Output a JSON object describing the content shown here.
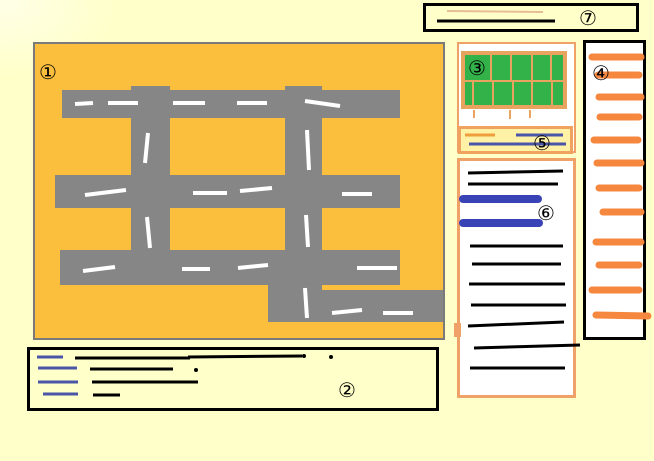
{
  "regions": {
    "map": {
      "label": "①"
    },
    "legend": {
      "label": "②"
    },
    "grid_table": {
      "label": "③"
    },
    "sidebar": {
      "label": "④"
    },
    "toolbar": {
      "label": "⑤"
    },
    "list": {
      "label": "⑥"
    },
    "titlebar": {
      "label": "⑦"
    }
  },
  "colors": {
    "page_bg": "#FFFFC9",
    "map_bg": "#FBBE3D",
    "map_border": "#7A7A7A",
    "road": "#868686",
    "dash": "#FFFFFF",
    "panel_border": "#F0A167",
    "panel_border2": "#F0A25F",
    "green": "#33B24A",
    "grid": "#E8A35F",
    "toolbar_bg": "#FFF1A6",
    "blue": "#4A55A8",
    "royal": "#3A43B5",
    "orange": "#F6873E",
    "orange2": "#EF9E3D",
    "tan": "#E7BD96",
    "black": "#000000"
  },
  "sketch": {
    "map": {
      "roads": [
        [
          27,
          46,
          338,
          28
        ],
        [
          20,
          131,
          345,
          33
        ],
        [
          25,
          206,
          340,
          35
        ],
        [
          96,
          42,
          39,
          199
        ],
        [
          250,
          42,
          37,
          172
        ],
        [
          233,
          206,
          54,
          72
        ],
        [
          265,
          246,
          143,
          32
        ]
      ],
      "dashes": [
        [
          40,
          60,
          58,
          59
        ],
        [
          73,
          59,
          103,
          59
        ],
        [
          138,
          59,
          170,
          59
        ],
        [
          202,
          59,
          232,
          59
        ],
        [
          270,
          57,
          305,
          62
        ],
        [
          50,
          151,
          91,
          146
        ],
        [
          158,
          149,
          192,
          149
        ],
        [
          205,
          147,
          237,
          144
        ],
        [
          307,
          150,
          337,
          150
        ],
        [
          48,
          227,
          80,
          223
        ],
        [
          147,
          225,
          175,
          225
        ],
        [
          203,
          224,
          233,
          221
        ],
        [
          322,
          224,
          362,
          224
        ],
        [
          297,
          269,
          327,
          266
        ],
        [
          348,
          269,
          378,
          269
        ],
        [
          113,
          89,
          110,
          119
        ],
        [
          112,
          173,
          115,
          204
        ],
        [
          272,
          86,
          274,
          126
        ],
        [
          271,
          171,
          273,
          203
        ],
        [
          270,
          244,
          272,
          274
        ]
      ]
    },
    "legend": {
      "blue": [
        [
          7,
          7,
          33,
          7
        ],
        [
          8,
          18,
          47,
          18
        ],
        [
          8,
          32,
          48,
          32
        ],
        [
          13,
          44,
          48,
          44
        ]
      ],
      "black": [
        [
          45,
          8,
          160,
          8
        ],
        [
          158,
          7,
          272,
          6
        ],
        [
          60,
          19,
          143,
          19
        ],
        [
          62,
          32,
          168,
          32
        ],
        [
          63,
          45,
          90,
          45
        ]
      ],
      "dots": [
        [
          274,
          6
        ],
        [
          301,
          7
        ],
        [
          166,
          20
        ]
      ]
    },
    "titlebar": {
      "tan_line": [
        21,
        5,
        117,
        6
      ],
      "black_line": [
        11,
        15,
        129,
        15
      ]
    },
    "grid_table": {
      "rect": [
        4,
        9,
        102,
        54
      ],
      "grid": [
        [
          5,
          37,
          107,
          37
        ],
        [
          32,
          11,
          32,
          37
        ],
        [
          52,
          11,
          52,
          37
        ],
        [
          73,
          11,
          73,
          37
        ],
        [
          92,
          11,
          92,
          37
        ],
        [
          14,
          37,
          14,
          63
        ],
        [
          34,
          37,
          34,
          63
        ],
        [
          54,
          37,
          54,
          63
        ],
        [
          73,
          37,
          73,
          63
        ],
        [
          93,
          37,
          93,
          63
        ]
      ],
      "ticks": [
        [
          15,
          66,
          15,
          74
        ],
        [
          51,
          66,
          51,
          75
        ],
        [
          71,
          66,
          71,
          74
        ]
      ]
    },
    "toolbar": {
      "orange_line": [
        4,
        6,
        34,
        6
      ],
      "blue": [
        [
          55,
          6,
          102,
          6
        ],
        [
          8,
          15,
          105,
          15
        ]
      ]
    },
    "list": {
      "black": [
        [
          8,
          12,
          103,
          10
        ],
        [
          8,
          23,
          98,
          23
        ],
        [
          10,
          85,
          103,
          85
        ],
        [
          12,
          103,
          101,
          103
        ],
        [
          9,
          123,
          105,
          123
        ],
        [
          11,
          144,
          106,
          144
        ],
        [
          8,
          165,
          104,
          161
        ],
        [
          14,
          187,
          120,
          184
        ],
        [
          10,
          207,
          105,
          207
        ]
      ],
      "blue_bars": [
        [
          3,
          38,
          78,
          38
        ],
        [
          3,
          62,
          79,
          62
        ]
      ]
    },
    "sidebar": {
      "strokes": [
        [
          6,
          14,
          55,
          14
        ],
        [
          12,
          32,
          53,
          32
        ],
        [
          13,
          54,
          55,
          54
        ],
        [
          14,
          74,
          53,
          74
        ],
        [
          8,
          97,
          52,
          97
        ],
        [
          11,
          120,
          55,
          120
        ],
        [
          13,
          145,
          53,
          145
        ],
        [
          17,
          169,
          55,
          169
        ],
        [
          10,
          199,
          55,
          199
        ],
        [
          13,
          222,
          53,
          222
        ],
        [
          6,
          247,
          53,
          247
        ],
        [
          10,
          272,
          62,
          273
        ]
      ]
    }
  }
}
